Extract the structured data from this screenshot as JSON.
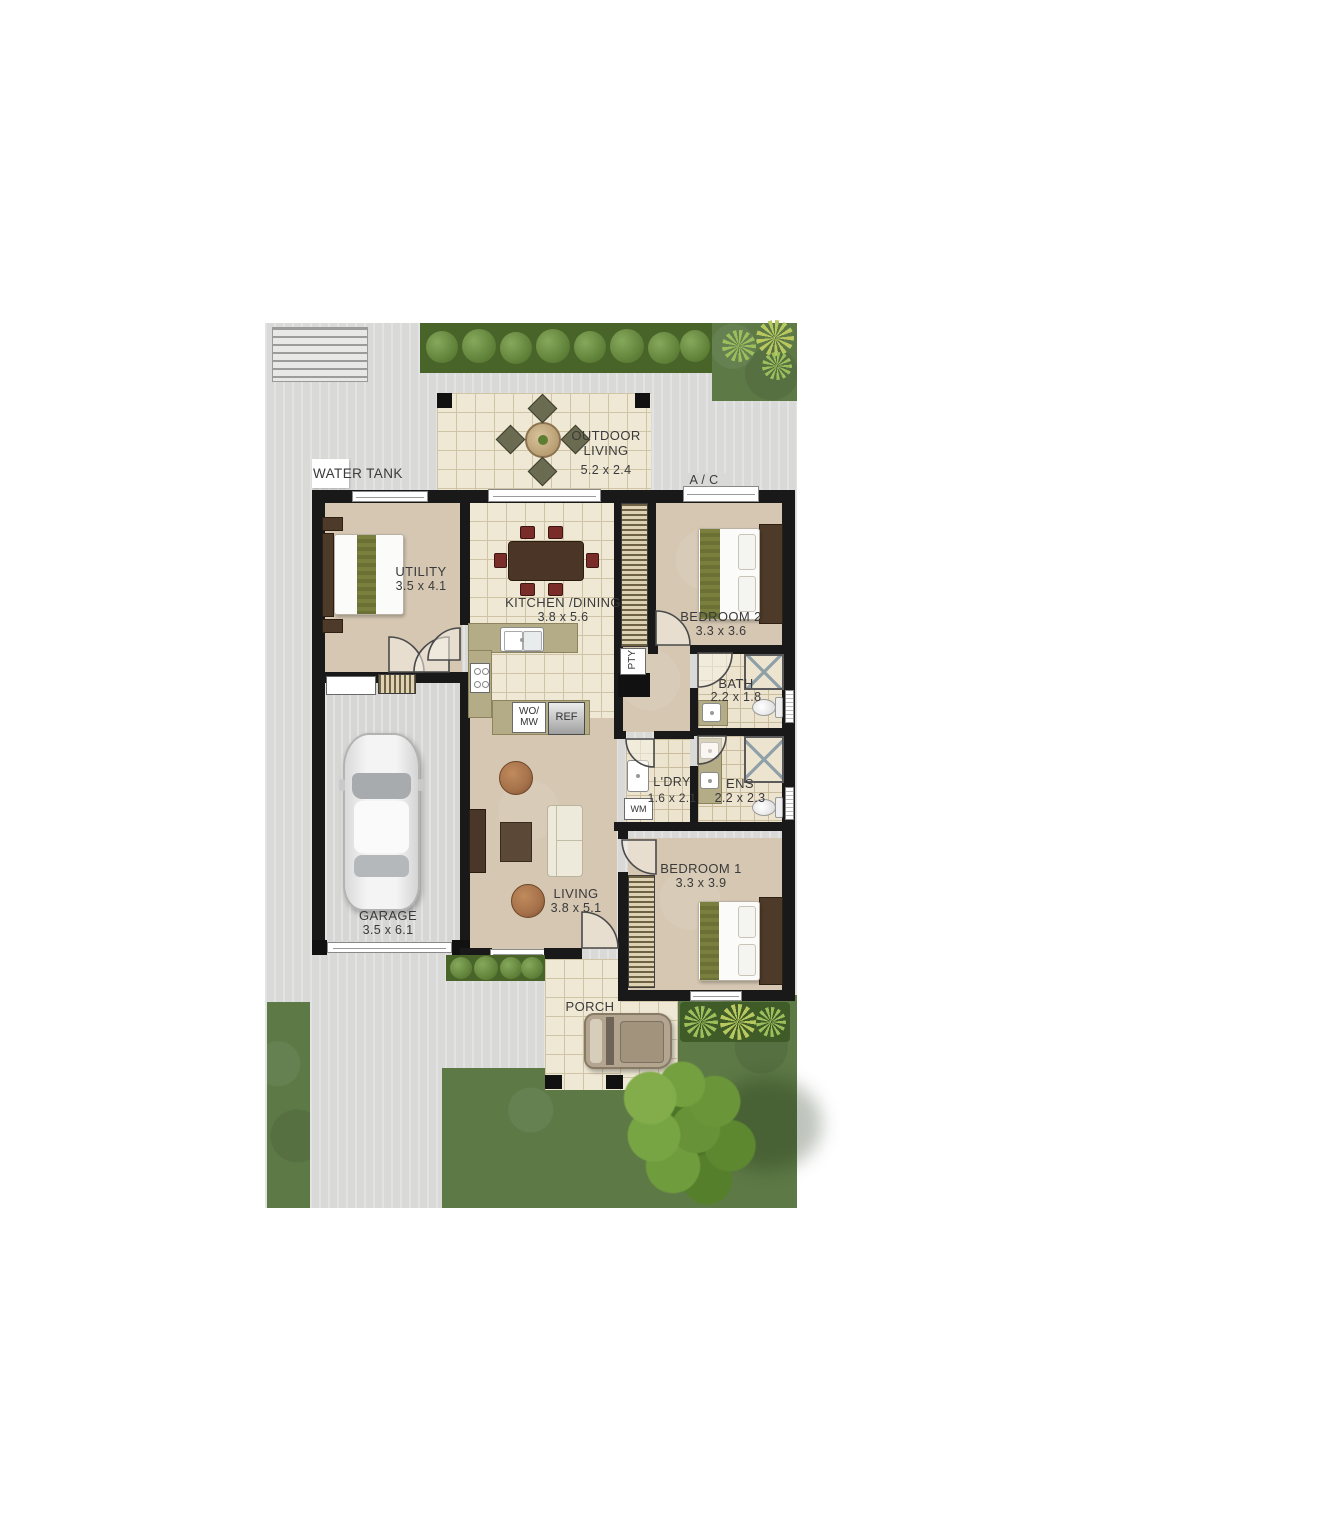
{
  "plan": {
    "annotations": {
      "water_tank": "WATER TANK",
      "ac": "A / C"
    },
    "rooms": {
      "outdoor_living": {
        "line1": "OUTDOOR",
        "line2": "LIVING",
        "dims": "5.2 x 2.4"
      },
      "utility": {
        "label": "UTILITY",
        "dims": "3.5 x 4.1"
      },
      "kitchen_dining": {
        "label": "KITCHEN /DINING",
        "dims": "3.8 x 5.6"
      },
      "bedroom2": {
        "label": "BEDROOM 2",
        "dims": "3.3 x 3.6"
      },
      "bath": {
        "label": "BATH",
        "dims": "2.2 x 1.8"
      },
      "laundry": {
        "label": "L'DRY",
        "dims": "1.6 x 2.1"
      },
      "ensuite": {
        "label": "ENS",
        "dims": "2.2 x 2.3"
      },
      "bedroom1": {
        "label": "BEDROOM 1",
        "dims": "3.3 x 3.9"
      },
      "living": {
        "label": "LIVING",
        "dims": "3.8 x 5.1"
      },
      "garage": {
        "label": "GARAGE",
        "dims": "3.5 x 6.1"
      },
      "porch": {
        "label": "PORCH"
      }
    },
    "fixtures": {
      "pantry": "PTY",
      "washing_machine": "WM",
      "oven_line1": "WO/",
      "oven_line2": "MW",
      "fridge": "REF"
    },
    "colors": {
      "wall": "#191919",
      "tile": "#efe8d4",
      "carpet": "#d5c7b2",
      "kitchen_bench": "#b4ab87",
      "paving": "#d9dad8",
      "grass": "#5d7946",
      "hedge": "#486429",
      "tree": "#6f9c3e",
      "bed_runner": "#7a7f3e"
    }
  }
}
